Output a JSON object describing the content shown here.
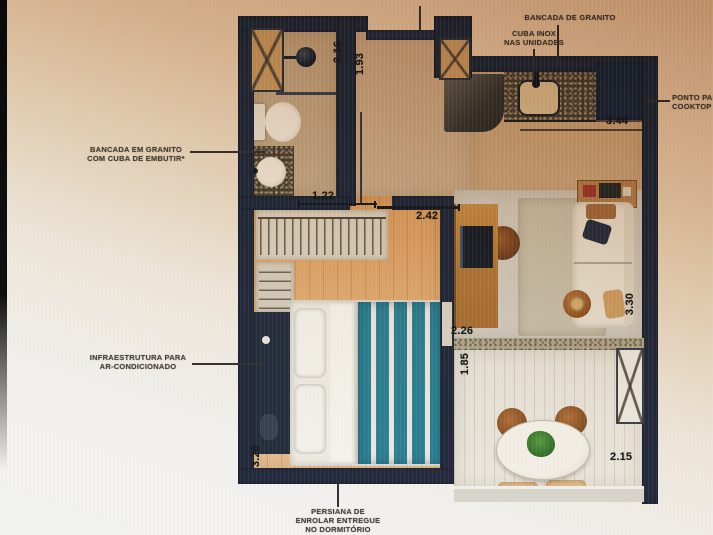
{
  "callouts": {
    "fechadura_digital": "FECHADURA DIGITAL",
    "bancada_de_granito": "BANCADA DE GRANITO",
    "cuba_inox": {
      "line1": "CUBA INOX",
      "line2": "NAS UNIDADES"
    },
    "ponto_cooktop": {
      "line1": "PONTO PARA",
      "line2": "COOKTOP"
    },
    "bancada_embutir": {
      "line1": "BANCADA EM GRANITO",
      "line2": "COM CUBA DE EMBUTIR*"
    },
    "infra_ar": {
      "line1": "INFRAESTRUTURA PARA",
      "line2": "AR-CONDICIONADO"
    },
    "persiana": {
      "line1": "PERSIANA DE",
      "line2": "ENROLAR ENTREGUE",
      "line3": "NO DORMITÓRIO"
    }
  },
  "dimensions_m": {
    "bath_depth": "2.16",
    "hall_depth": "1.93",
    "bath_width": "1.22",
    "bedroom_width_top": "2.42",
    "kitchen_width": "3.44",
    "living_width": "2.26",
    "balcony_depth": "1.85",
    "living_depth": "3.30",
    "bedroom_depth": "3.20",
    "balcony_width": "2.15"
  },
  "colors": {
    "wall": "#242b3d",
    "wood_floor": "#dda162",
    "teal_bedding": "#2d7f93",
    "granite": "#494133",
    "photo_tint_top": "#a96f3e",
    "photo_bg_bottom": "#f2f2f0"
  }
}
